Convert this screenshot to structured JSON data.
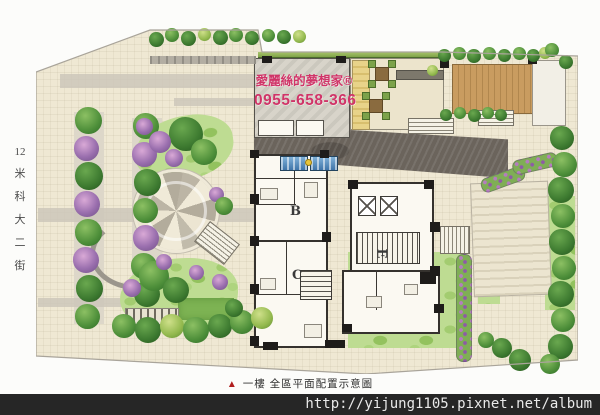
{
  "overlay": {
    "brand": "愛麗絲的夢想家®",
    "phone": "0955-658-366"
  },
  "street": {
    "label": "12米科大二街",
    "chars": [
      "12",
      "米",
      "科",
      "大",
      "二",
      "街"
    ]
  },
  "units": {
    "b": "B",
    "c": "C",
    "e": "E"
  },
  "caption": {
    "marker": "▲",
    "text": "一樓 全區平面配置示意圖"
  },
  "footer": {
    "url": "http://yijung1105.pixnet.net/album"
  },
  "colors": {
    "brand_red": "#d03468",
    "caption_red": "#b01d1d",
    "footer_bg": "#262626",
    "paving_beige": "#efe8d3",
    "lawn_green": "#bedc92",
    "deck_wood": "#c89b60",
    "pool_blue": "#4d86bd",
    "driveway_gray": "#6b645c"
  }
}
